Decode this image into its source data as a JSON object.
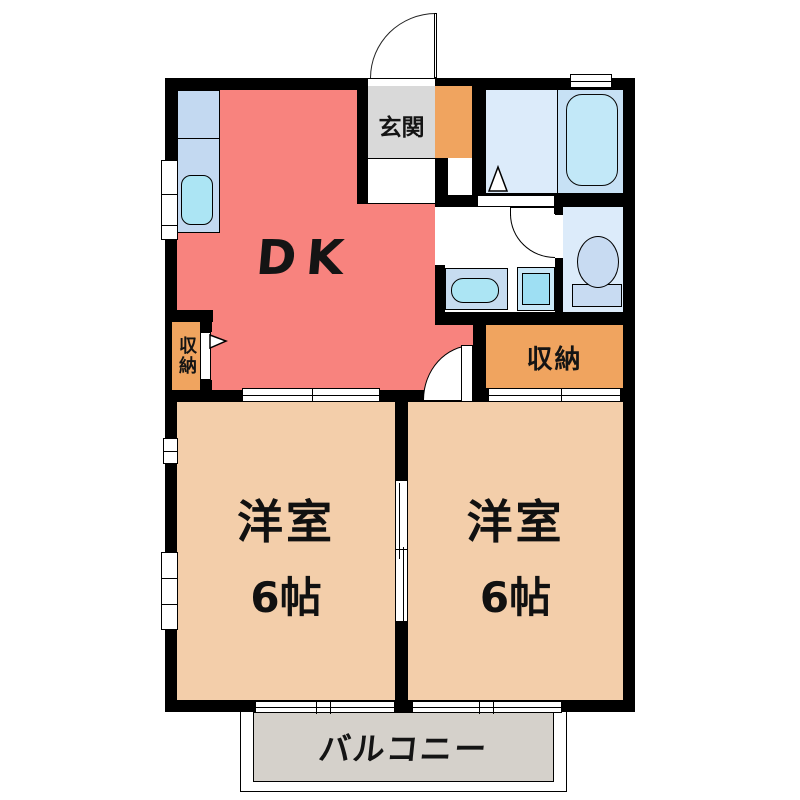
{
  "floorplan": {
    "dk_label": "DK",
    "entrance_label": "玄関",
    "closet_left_label": "収納",
    "closet_right_label": "収納",
    "bedroom_left": {
      "name": "洋室",
      "size": "6帖"
    },
    "bedroom_right": {
      "name": "洋室",
      "size": "6帖"
    },
    "balcony_label": "バルコニー",
    "colors": {
      "wall": "#000000",
      "dk": "#F8837E",
      "bedroom": "#F3CEAA",
      "closet": "#F0A45F",
      "entrance_hall": "#D9D9D9",
      "balcony_deck": "#D5D1CB",
      "wet_area_blue": "#DCEBFA",
      "bath_blue": "#C7E1F5",
      "bathtub": "#C2E8F8",
      "fixture_cyan": "#ACE5F4",
      "kitchen_counter": "#C3D9F1"
    }
  }
}
